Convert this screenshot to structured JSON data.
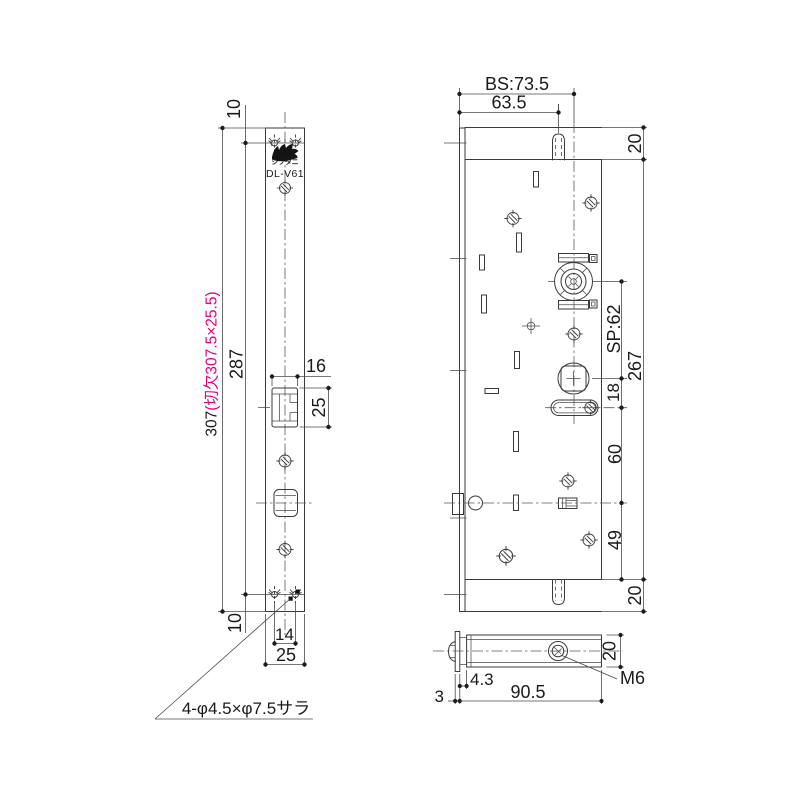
{
  "meta": {
    "drawing_type": "mortise lock technical drawing",
    "colors": {
      "line": "#3a3a3a",
      "text": "#1a1a1a",
      "accent_pink": "#e6007e",
      "background": "#ffffff"
    }
  },
  "front_view": {
    "brand": "シブタニ",
    "model": "DL-V61",
    "dim_top_offset": "10",
    "dim_hole_span": "287",
    "dim_overall_black": "307",
    "dim_overall_pink": "(切欠307.5×25.5)",
    "dim_latch_width": "16",
    "dim_latch_height": "25",
    "dim_bottom_offset": "10",
    "dim_hole_pitch": "14",
    "dim_plate_width": "25",
    "note_holes": "4-φ4.5×φ7.5サラ"
  },
  "side_view": {
    "dim_backset": "BS:73.5",
    "dim_tab_offset": "63.5",
    "dim_top_margin": "20",
    "dim_spindle_pitch": "SP:62",
    "dim_body_height": "267",
    "dim_spindle_to_slot": "18",
    "dim_slot_to_center": "60",
    "dim_center_to_bottom": "49",
    "dim_bottom_margin": "20"
  },
  "bottom_view": {
    "dim_plate_to_case": "4.3",
    "dim_case_depth": "90.5",
    "dim_plate_thickness": "3",
    "dim_case_width": "20",
    "label_thread": "M6"
  }
}
